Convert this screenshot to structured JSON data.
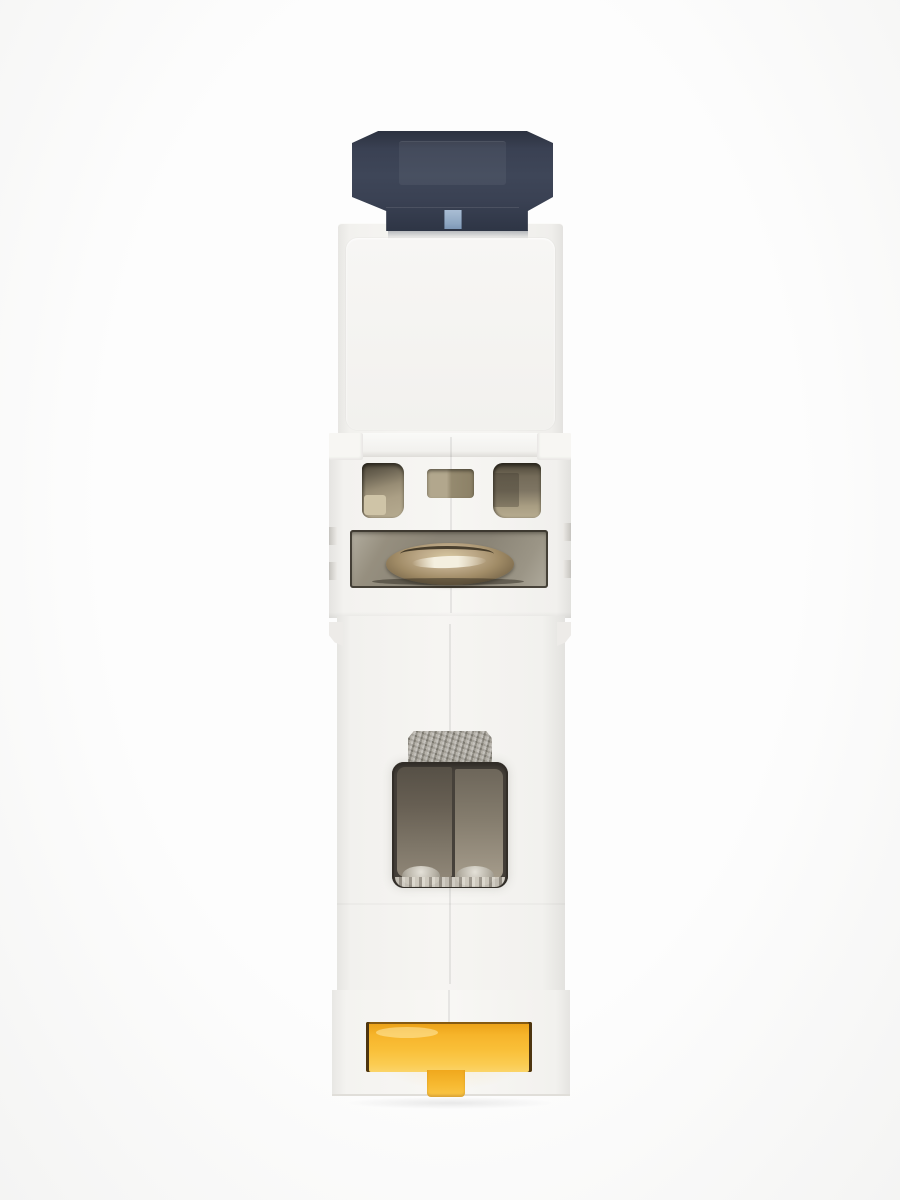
{
  "scene": {
    "description": "Product photo: bottom/end view of a white single-module DIN-rail miniature circuit breaker on a plain white background",
    "orientation": "vertical, centered",
    "visible_text": "none"
  },
  "parts": {
    "toggle": "dark slate actuator lever with light-blue indicator mark",
    "housing": "white plastic body in four stepped sections",
    "vents": "three tan-lined openings (left, center, right)",
    "terminal_screw": "brass screw head seen edge-on inside a wide slot",
    "terminal_cage": "square clamp opening with taupe metal plates and silver base",
    "metal_tab": "rough silver metal tab above the clamp opening",
    "din_clip": "yellow T-shaped DIN-rail latch at the bottom"
  },
  "colors": {
    "bg-white": "#fdfdfd",
    "body-white": "#f6f5f2",
    "body-edge": "#e3e2df",
    "toggle-dark": "#3a4153",
    "toggle-edge": "#2c3240",
    "marker-blue": "#8fa7c2",
    "vent-tan": "#ab9f85",
    "vent-dark": "#4a4436",
    "vent-light": "#cfc4a7",
    "slot-grey": "#8a8476",
    "brass": "#a08b66",
    "brass-hi": "#f4efdf",
    "brass-dark": "#5c4d36",
    "metal-silver": "#9a968d",
    "terminal-dark": "#5b544a",
    "terminal-taupe": "#8a8173",
    "silver-hi": "#dcd8cd",
    "clip-yellow": "#f6b42a",
    "clip-yellow-lo": "#fbcc52",
    "clip-outline": "#4d3510"
  }
}
